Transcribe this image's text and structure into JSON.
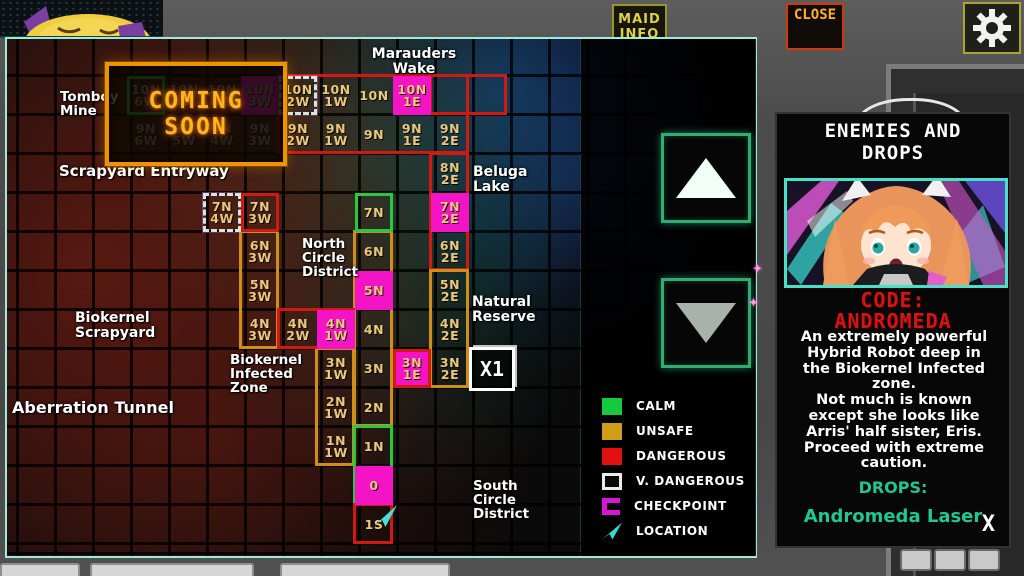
{
  "top_bar": {
    "maid_info": {
      "line1": "MAID",
      "line2": "INFO"
    },
    "close_label": "CLOSE",
    "settings_icon": "gear"
  },
  "icons": {
    "sparkle": "✦"
  },
  "map": {
    "grid": {
      "x0": 120,
      "y0": 37,
      "cw": 38,
      "rh": 39
    },
    "coming_soon": {
      "line1": "COMING",
      "line2": "SOON"
    },
    "x1_label": "X1",
    "cells": [
      {
        "l1": "10N",
        "l2": "6W",
        "c": 0,
        "r": 0,
        "mods": "dim b-green"
      },
      {
        "l1": "10N",
        "l2": "5W",
        "c": 1,
        "r": 0,
        "mods": "dim"
      },
      {
        "l1": "10N",
        "l2": "4W",
        "c": 2,
        "r": 0,
        "mods": "dim"
      },
      {
        "l1": "10N",
        "l2": "3W",
        "c": 3,
        "r": 0,
        "mods": "dim magenta"
      },
      {
        "l1": "10N",
        "l2": "2W",
        "c": 4,
        "r": 0,
        "mods": "b-sparkle"
      },
      {
        "l1": "10N",
        "l2": "1W",
        "c": 5,
        "r": 0,
        "mods": ""
      },
      {
        "l1": "10N",
        "l2": "",
        "c": 6,
        "r": 0,
        "mods": ""
      },
      {
        "l1": "10N",
        "l2": "1E",
        "c": 7,
        "r": 0,
        "mods": "magenta"
      },
      {
        "l1": "9N",
        "l2": "6W",
        "c": 0,
        "r": 1,
        "mods": "dim"
      },
      {
        "l1": "9N",
        "l2": "5W",
        "c": 1,
        "r": 1,
        "mods": "dim"
      },
      {
        "l1": "9N",
        "l2": "4W",
        "c": 2,
        "r": 1,
        "mods": "dim"
      },
      {
        "l1": "9N",
        "l2": "3W",
        "c": 3,
        "r": 1,
        "mods": "dim"
      },
      {
        "l1": "9N",
        "l2": "2W",
        "c": 4,
        "r": 1,
        "mods": ""
      },
      {
        "l1": "9N",
        "l2": "1W",
        "c": 5,
        "r": 1,
        "mods": ""
      },
      {
        "l1": "9N",
        "l2": "",
        "c": 6,
        "r": 1,
        "mods": ""
      },
      {
        "l1": "9N",
        "l2": "1E",
        "c": 7,
        "r": 1,
        "mods": ""
      },
      {
        "l1": "9N",
        "l2": "2E",
        "c": 8,
        "r": 1,
        "mods": ""
      },
      {
        "l1": "8N",
        "l2": "2E",
        "c": 8,
        "r": 2,
        "mods": ""
      },
      {
        "l1": "7N",
        "l2": "4W",
        "c": 2,
        "r": 3,
        "mods": "b-sparkle"
      },
      {
        "l1": "7N",
        "l2": "3W",
        "c": 3,
        "r": 3,
        "mods": "b-red"
      },
      {
        "l1": "7N",
        "l2": "",
        "c": 6,
        "r": 3,
        "mods": "b-green"
      },
      {
        "l1": "7N",
        "l2": "2E",
        "c": 8,
        "r": 3,
        "mods": "magenta"
      },
      {
        "l1": "6N",
        "l2": "3W",
        "c": 3,
        "r": 4,
        "mods": ""
      },
      {
        "l1": "6N",
        "l2": "",
        "c": 6,
        "r": 4,
        "mods": ""
      },
      {
        "l1": "6N",
        "l2": "2E",
        "c": 8,
        "r": 4,
        "mods": ""
      },
      {
        "l1": "5N",
        "l2": "3W",
        "c": 3,
        "r": 5,
        "mods": ""
      },
      {
        "l1": "5N",
        "l2": "",
        "c": 6,
        "r": 5,
        "mods": "magenta"
      },
      {
        "l1": "5N",
        "l2": "2E",
        "c": 8,
        "r": 5,
        "mods": ""
      },
      {
        "l1": "4N",
        "l2": "3W",
        "c": 3,
        "r": 6,
        "mods": ""
      },
      {
        "l1": "4N",
        "l2": "2W",
        "c": 4,
        "r": 6,
        "mods": ""
      },
      {
        "l1": "4N",
        "l2": "1W",
        "c": 5,
        "r": 6,
        "mods": "magenta"
      },
      {
        "l1": "4N",
        "l2": "",
        "c": 6,
        "r": 6,
        "mods": ""
      },
      {
        "l1": "4N",
        "l2": "2E",
        "c": 8,
        "r": 6,
        "mods": ""
      },
      {
        "l1": "3N",
        "l2": "1W",
        "c": 5,
        "r": 7,
        "mods": ""
      },
      {
        "l1": "3N",
        "l2": "",
        "c": 6,
        "r": 7,
        "mods": ""
      },
      {
        "l1": "3N",
        "l2": "1E",
        "c": 7,
        "r": 7,
        "mods": "magenta b-red"
      },
      {
        "l1": "3N",
        "l2": "2E",
        "c": 8,
        "r": 7,
        "mods": ""
      },
      {
        "l1": "2N",
        "l2": "1W",
        "c": 5,
        "r": 8,
        "mods": ""
      },
      {
        "l1": "2N",
        "l2": "",
        "c": 6,
        "r": 8,
        "mods": ""
      },
      {
        "l1": "1N",
        "l2": "1W",
        "c": 5,
        "r": 9,
        "mods": ""
      },
      {
        "l1": "1N",
        "l2": "",
        "c": 6,
        "r": 9,
        "mods": ""
      },
      {
        "l1": "0",
        "l2": "",
        "c": 6,
        "r": 10,
        "mods": "magenta"
      },
      {
        "l1": "1S",
        "l2": "",
        "c": 6,
        "r": 11,
        "mods": ""
      }
    ],
    "outlines": [
      {
        "c": 4,
        "r": 0,
        "w": 5,
        "h": 2,
        "color": "red"
      },
      {
        "c": 8,
        "r": 0,
        "w": 2,
        "h": 1,
        "color": "red"
      },
      {
        "c": 8,
        "r": 2,
        "w": 1,
        "h": 3,
        "color": "red"
      },
      {
        "c": 3,
        "r": 4,
        "w": 1,
        "h": 3,
        "color": "orange"
      },
      {
        "c": 8,
        "r": 5,
        "w": 1,
        "h": 3,
        "color": "orange"
      },
      {
        "c": 5,
        "r": 7,
        "w": 1,
        "h": 3,
        "color": "orange"
      },
      {
        "c": 6,
        "r": 4,
        "w": 1,
        "h": 5,
        "color": "orange"
      },
      {
        "c": 4,
        "r": 6,
        "w": 2,
        "h": 1,
        "color": "red"
      },
      {
        "c": 6,
        "r": 9,
        "w": 1,
        "h": 2,
        "color": "green"
      },
      {
        "c": 6,
        "r": 11,
        "w": 1,
        "h": 1,
        "color": "red"
      }
    ],
    "labels": [
      {
        "text": "Marauders\nWake",
        "x": 352,
        "y": 8,
        "w": 110,
        "align": "center",
        "size": 14
      },
      {
        "text": "Tomboy\nMine",
        "x": 53,
        "y": 51,
        "size": 13.5
      },
      {
        "text": "Scrapyard Entryway",
        "x": 52,
        "y": 125,
        "size": 15
      },
      {
        "text": "Beluga\nLake",
        "x": 466,
        "y": 126,
        "size": 14
      },
      {
        "text": "North\nCircle\nDistrict",
        "x": 295,
        "y": 198,
        "size": 13.5
      },
      {
        "text": "Natural\nReserve",
        "x": 465,
        "y": 256,
        "size": 14
      },
      {
        "text": "Biokernel\nScrapyard",
        "x": 68,
        "y": 272,
        "size": 14
      },
      {
        "text": "Biokernel\nInfected\nZone",
        "x": 223,
        "y": 314,
        "size": 13.5
      },
      {
        "text": "Aberration Tunnel",
        "x": 5,
        "y": 361,
        "size": 16
      },
      {
        "text": "South\nCircle\nDistrict",
        "x": 466,
        "y": 440,
        "size": 13.5
      }
    ]
  },
  "legend": {
    "items": [
      {
        "swatch": "calm",
        "label": "CALM",
        "color": "#17c93c"
      },
      {
        "swatch": "unsafe",
        "label": "UNSAFE",
        "color": "#d19c18"
      },
      {
        "swatch": "dangerous",
        "label": "DANGEROUS",
        "color": "#e31010"
      },
      {
        "swatch": "vdangerous",
        "label": "V. DANGEROUS",
        "color": "#ececec"
      },
      {
        "swatch": "checkpoint",
        "label": "CHECKPOINT",
        "color": "#d816d8"
      },
      {
        "swatch": "location",
        "label": "LOCATION",
        "color": "#3bd6cf"
      }
    ]
  },
  "panel": {
    "title_line1": "ENEMIES AND",
    "title_line2": "DROPS",
    "code_line1": "CODE:",
    "code_line2": "ANDROMEDA",
    "description_lines": [
      "An extremely powerful",
      "Hybrid Robot deep in",
      "the Biokernel Infected",
      "zone.",
      "Not much is known",
      "except she looks like",
      "Arris' half sister, Eris.",
      "Proceed with extreme",
      "caution."
    ],
    "drops_label": "DROPS:",
    "drop_item": "Andromeda Laser",
    "close_x": "X"
  },
  "colors": {
    "panel_border": "#9fe9dd",
    "checkpoint_fill": "#f513c6",
    "cell_text": "#ecc87c",
    "danger_red": "#d01910",
    "unsafe_orange": "#cf8d1b",
    "calm_green": "#28c840",
    "coming_soon_orange": "#ffb51e",
    "code_red": "#d31414",
    "drops_teal": "#1fc793"
  }
}
